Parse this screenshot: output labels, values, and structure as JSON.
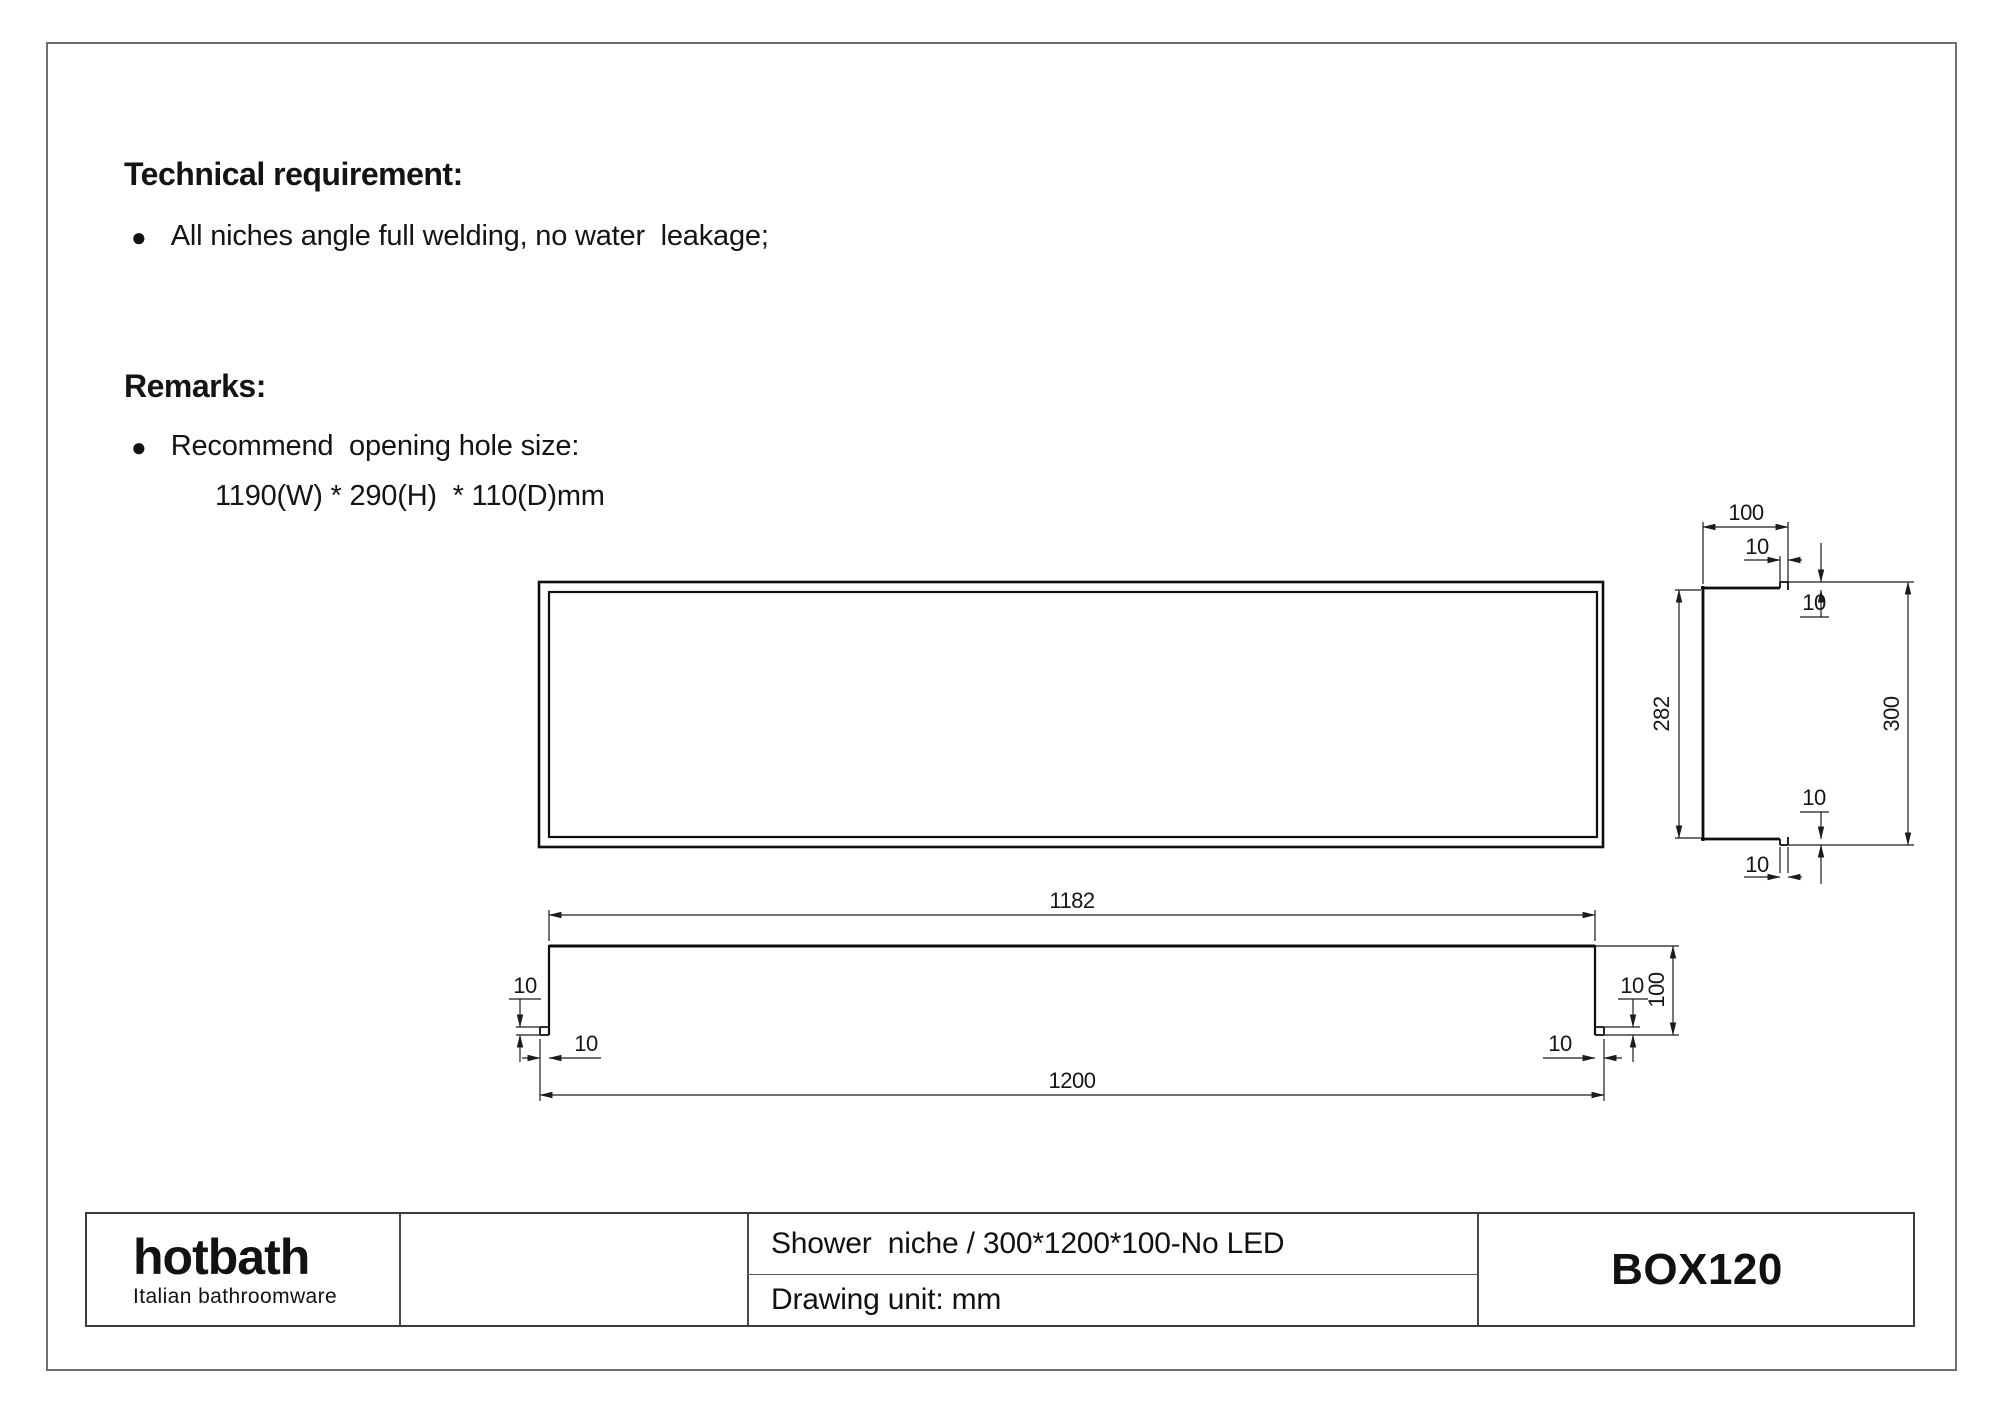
{
  "notes": {
    "technical_heading": "Technical requirement:",
    "technical_items": [
      "All niches angle full welding, no water  leakage;"
    ],
    "remarks_heading": "Remarks:",
    "remarks_items": [
      "Recommend  opening hole size:"
    ],
    "remarks_detail": "1190(W) * 290(H)  * 110(D)mm"
  },
  "drawing": {
    "side_view": {
      "depth": "100",
      "lip_w_top": "10",
      "lip_h_top": "10",
      "inner_height": "282",
      "outer_height": "300",
      "lip_h_bottom": "10",
      "lip_w_bottom": "10"
    },
    "bottom_view": {
      "inner_width": "1182",
      "outer_width": "1200",
      "lip_v_left": "10",
      "lip_h_left": "10",
      "lip_v_right": "10",
      "lip_h_right": "10",
      "depth": "100"
    }
  },
  "title_block": {
    "logo": "hotbath",
    "logo_tagline": "Italian bathroomware",
    "description": "Shower  niche / 300*1200*100-No LED",
    "drawing_unit": "Drawing unit: mm",
    "model": "BOX120"
  },
  "colors": {
    "line": "#0e0e0e",
    "dimension": "#1c1c1c",
    "page_border": "#6e6e6e"
  }
}
